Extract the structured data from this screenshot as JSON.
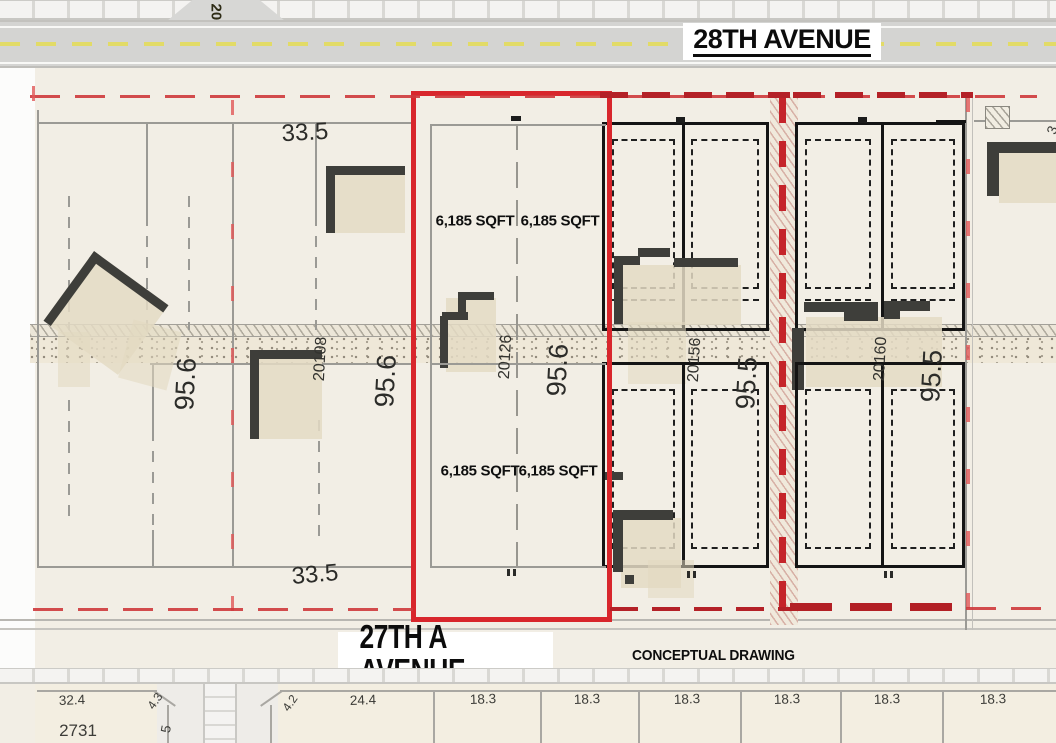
{
  "streets": {
    "top": "28TH AVENUE",
    "bottom": "27TH A AVENUE",
    "side": "201"
  },
  "note": "CONCEPTUAL DRAWING",
  "subject_parcel": {
    "lot_area_nw": "6,185 SQFT",
    "lot_area_ne": "6,185 SQFT",
    "lot_area_sw": "6,185 SQFT",
    "lot_area_se": "6,185 SQFT",
    "address": "20126",
    "depth": "95.6"
  },
  "west_block": {
    "width_top": "33.5",
    "width_bottom": "33.5",
    "depth_west": "95.6",
    "depth_east": "95.6",
    "address": "20108"
  },
  "east_block_1": {
    "address": "20156",
    "depth": "95.5"
  },
  "east_block_2": {
    "address": "20160",
    "depth": "95.5"
  },
  "edge_label_partial": "3",
  "south_lots": {
    "lot1_width": "32.4",
    "lot1_address": "2731",
    "lot1_corner": "4.3",
    "lot1_side": "5",
    "lot2_corner": "4.2",
    "lot2_width": "24.4",
    "narrow_lot_widths": [
      "18.3",
      "18.3",
      "18.3",
      "18.3",
      "18.3",
      "18.3"
    ]
  },
  "colors": {
    "parcel_red": "#d8262c",
    "dark_red": "#b21f24",
    "road_gray": "#d4d4d2",
    "centerline_yellow": "#e2db67",
    "line_gray": "#9b9a95",
    "black_line": "#141414",
    "building_dark": "#3e3e3a",
    "building_tan": "#e6dfc7",
    "paper": "#f2eee5"
  }
}
